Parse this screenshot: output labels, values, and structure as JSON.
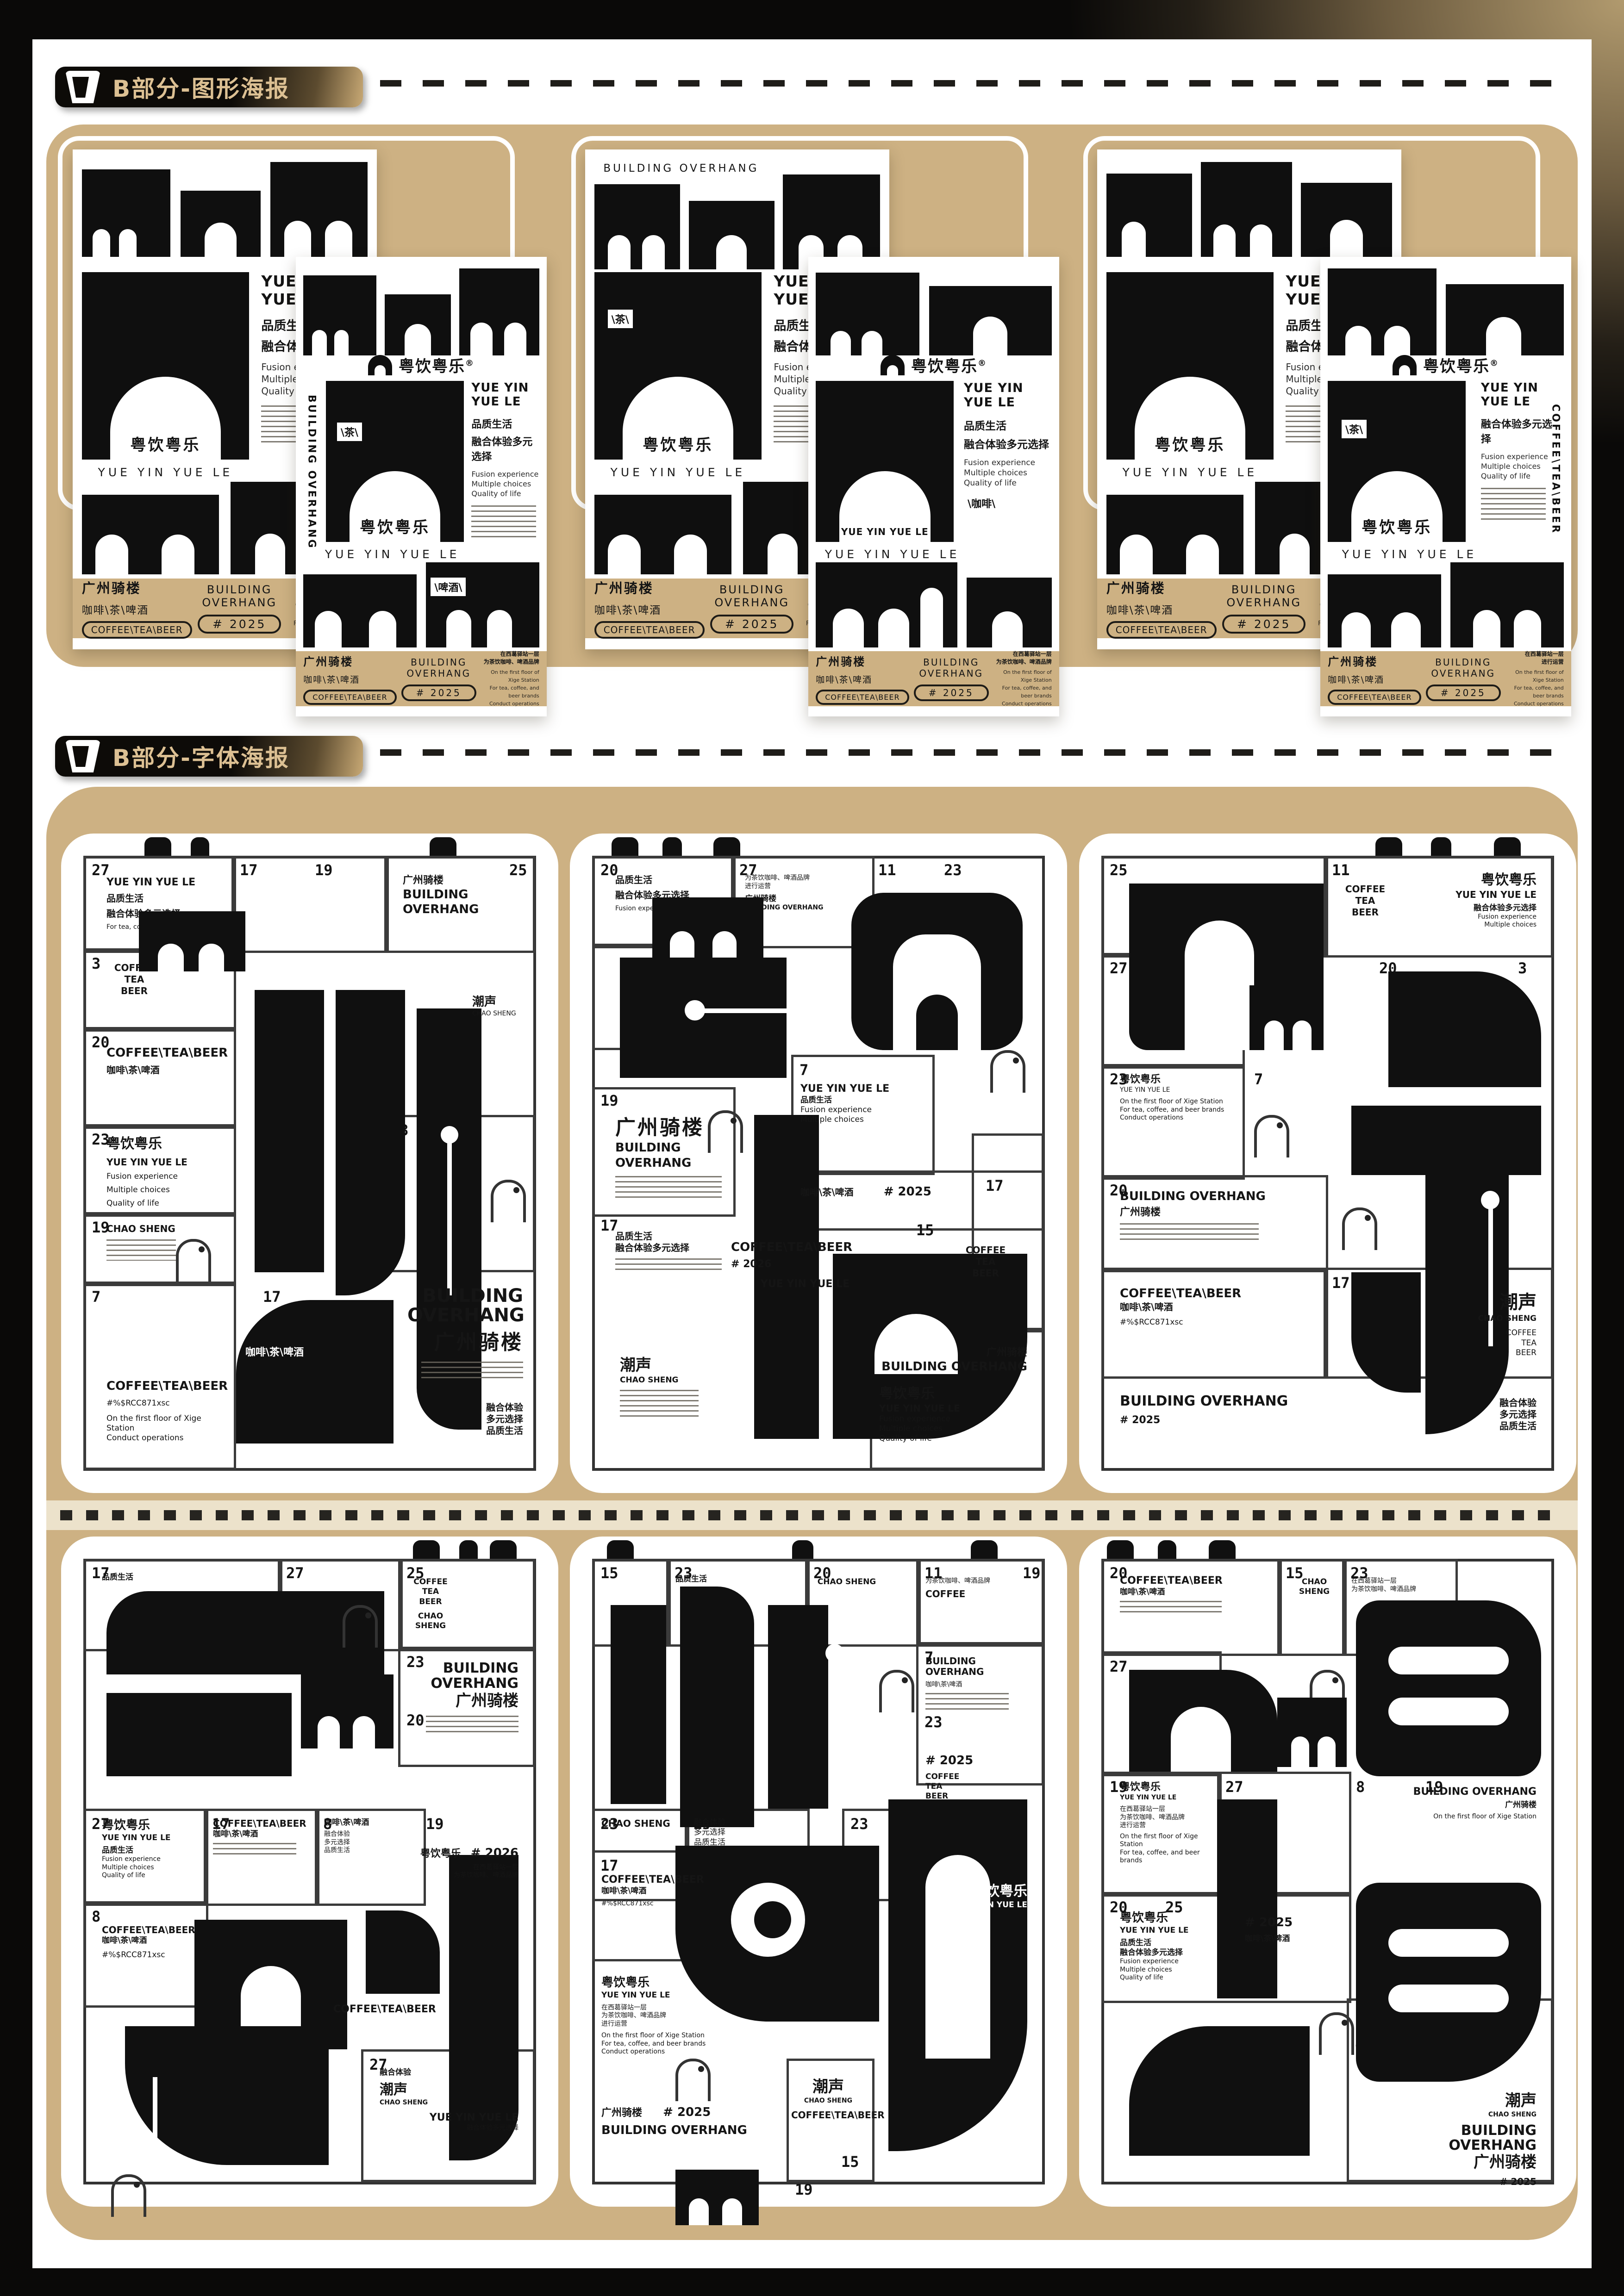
{
  "sections": [
    {
      "label": "B部分-图形海报"
    },
    {
      "label": "B部分-字体海报"
    }
  ],
  "brand": {
    "name_zh": "粤饮粤乐",
    "reg": "®",
    "name_en": "YUE YIN YUE LE",
    "tag_zh1": "品质生活",
    "tag_zh2": "融合体验多元选择",
    "tag_en1": "Fusion experience",
    "tag_en2": "Multiple choices",
    "tag_en3": "Quality of life"
  },
  "place": {
    "zh": "广州骑楼",
    "en": "BUILDING OVERHANG"
  },
  "drinks": {
    "zh": "咖啡\\茶\\啤酒",
    "en": "COFFEE\\TEA\\BEER",
    "coffee": "COFFEE",
    "tea": "TEA",
    "beer": "BEER",
    "tag_tea": "\\茶\\",
    "tag_coffee": "\\咖啡\\",
    "tag_beer": "\\啤酒\\"
  },
  "chao": {
    "zh": "潮声",
    "en": "CHAO SHENG"
  },
  "years": {
    "a": "# 2025",
    "b": "# 2026"
  },
  "note": {
    "zh1": "在西葛驿站一层",
    "zh2": "为茶饮咖啡、啤酒品牌",
    "zh3": "进行运营",
    "en1": "On the first floor of Xige Station",
    "en2": "For tea, coffee, and beer brands",
    "en3": "Conduct operations"
  },
  "fusion": {
    "l1": "融合体验",
    "l2": "多元选择",
    "l3": "品质生活"
  },
  "hashtag": "#%$RCC871xsc",
  "nums": {
    "n27": "27",
    "n17": "17",
    "n19": "19",
    "n25": "25",
    "n23": "23",
    "n20": "20",
    "n7": "7",
    "n3": "3",
    "n8": "8",
    "n15": "15",
    "n11": "11"
  }
}
